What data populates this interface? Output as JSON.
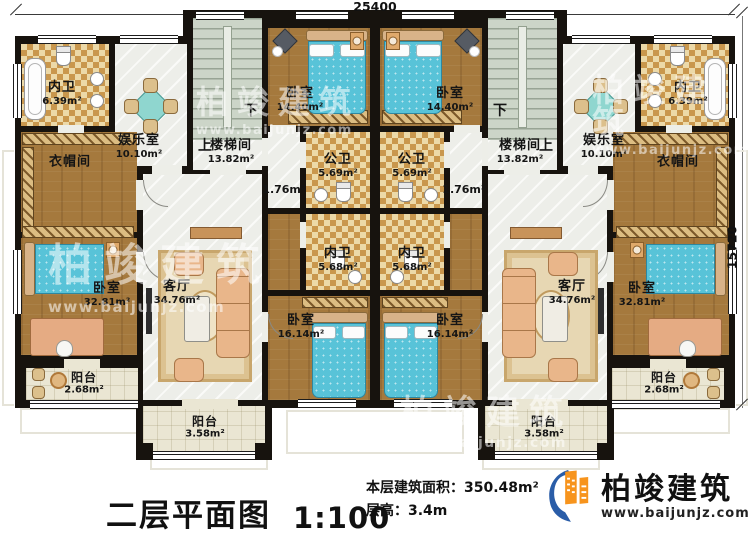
{
  "plan": {
    "dimensions": {
      "width": "25400",
      "height": "15720"
    },
    "stairs": {
      "up": "上",
      "down": "下"
    },
    "rooms": {
      "bath_ensuite_top": {
        "label": "内卫",
        "area": "6.39m²"
      },
      "recreation": {
        "label": "娱乐室",
        "area": "10.10m²"
      },
      "stairwell": {
        "label": "楼梯间",
        "area": "13.82m²"
      },
      "bedroom_top": {
        "label": "卧室",
        "area": "14.40m²"
      },
      "public_bath": {
        "label": "公卫",
        "area": "5.69m²"
      },
      "passage": {
        "area": "1.76m²"
      },
      "bath_ensuite_mid": {
        "label": "内卫",
        "area": "5.68m²"
      },
      "bedroom_mid": {
        "label": "卧室",
        "area": "16.14m²"
      },
      "cloakroom": {
        "label": "衣帽间"
      },
      "bedroom_master": {
        "label": "卧室",
        "area": "32.81m²"
      },
      "living": {
        "label": "客厅",
        "area": "34.76m²"
      },
      "balcony_small": {
        "label": "阳台",
        "area": "2.68m²"
      },
      "balcony_large": {
        "label": "阳台",
        "area": "3.58m²"
      }
    }
  },
  "footer": {
    "title": "二层平面图",
    "scale": "1:100",
    "area_line": "本层建筑面积：350.48m²",
    "height_line": "层高：3.4m"
  },
  "brand": {
    "name": "柏竣建筑",
    "url": "www.baijunjz.com"
  },
  "watermark": {
    "name": "柏竣建筑",
    "url": "www.baijunjz.com"
  },
  "colors": {
    "wall": "#17130e",
    "wood": "#a5793d",
    "tile": "#c9974d",
    "bed": "#58c3d8",
    "brand_blue": "#2a5da8",
    "brand_orange": "#f7941d"
  }
}
